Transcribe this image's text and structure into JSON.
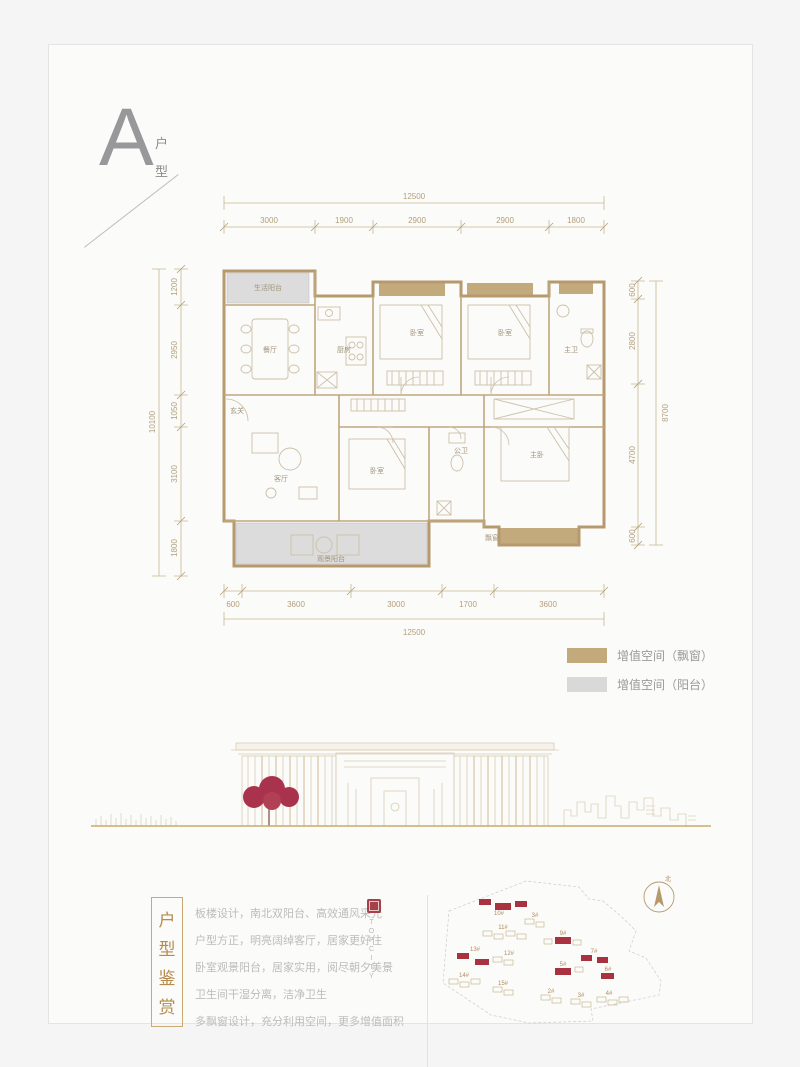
{
  "header": {
    "unit_letter": "A",
    "unit_char_1": "户",
    "unit_char_2": "型"
  },
  "plan": {
    "rooms": {
      "service_balcony": "生活阳台",
      "dining": "餐厅",
      "kitchen": "厨房",
      "bedroom_a": "卧室",
      "bedroom_b": "卧室",
      "master_bath": "主卫",
      "foyer": "玄关",
      "living": "客厅",
      "bedroom_c": "卧室",
      "bath": "公卫",
      "master_bedroom": "主卧",
      "view_balcony": "观景阳台",
      "bay_window": "飘窗"
    },
    "dims": {
      "top": {
        "total": "12500",
        "segments": [
          "3000",
          "1900",
          "2900",
          "2900",
          "1800"
        ]
      },
      "bottom": {
        "total": "12500",
        "segments": [
          "600",
          "3600",
          "3000",
          "1700",
          "3600"
        ]
      },
      "left": {
        "total": "10100",
        "segments": [
          "1200",
          "2950",
          "1050",
          "3100",
          "1800"
        ]
      },
      "right": {
        "total": "8700",
        "segments": [
          "600",
          "2800",
          "4700",
          "600"
        ]
      }
    }
  },
  "legend": {
    "items": [
      {
        "label": "增值空间（飘窗）",
        "color": "#c2aa7d"
      },
      {
        "label": "增值空间（阳台）",
        "color": "#d9d9d9"
      }
    ]
  },
  "appreciation": {
    "title_chars": [
      "户",
      "型",
      "鉴",
      "赏"
    ],
    "lines": [
      "板楼设计，南北双阳台、高效通风采光",
      "户型方正，明亮阔绰客厅，居家更好住",
      "卧室观景阳台，居家实用，阅尽朝夕美景",
      "卫生间干湿分离，洁净卫生",
      "多飘窗设计，充分利用空间，更多增值面积"
    ],
    "brand_vertical": "TOPCITY"
  },
  "siteplan": {
    "north_label": "北",
    "buildings": [
      {
        "label": "10#",
        "highlighted": true
      },
      {
        "label": "3#",
        "highlighted": false
      },
      {
        "label": "11#",
        "highlighted": false
      },
      {
        "label": "9#",
        "highlighted": true
      },
      {
        "label": "13#",
        "highlighted": true
      },
      {
        "label": "12#",
        "highlighted": false
      },
      {
        "label": "7#",
        "highlighted": true
      },
      {
        "label": "5#",
        "highlighted": true
      },
      {
        "label": "6#",
        "highlighted": true
      },
      {
        "label": "14#",
        "highlighted": false
      },
      {
        "label": "15#",
        "highlighted": false
      },
      {
        "label": "2#",
        "highlighted": false
      },
      {
        "label": "3#",
        "highlighted": false
      },
      {
        "label": "4#",
        "highlighted": false
      }
    ]
  },
  "colors": {
    "wall_tan": "#b69a6e",
    "bay_window_fill": "#c2aa7d",
    "balcony_fill": "#dcdcdc",
    "dim_text": "#b3a07c",
    "highlight_red": "#a83240",
    "seal_red": "#a5414b",
    "tree_red": "#a9334d",
    "body_text_gray": "#bcbcbc",
    "title_tan": "#b68b4c"
  }
}
